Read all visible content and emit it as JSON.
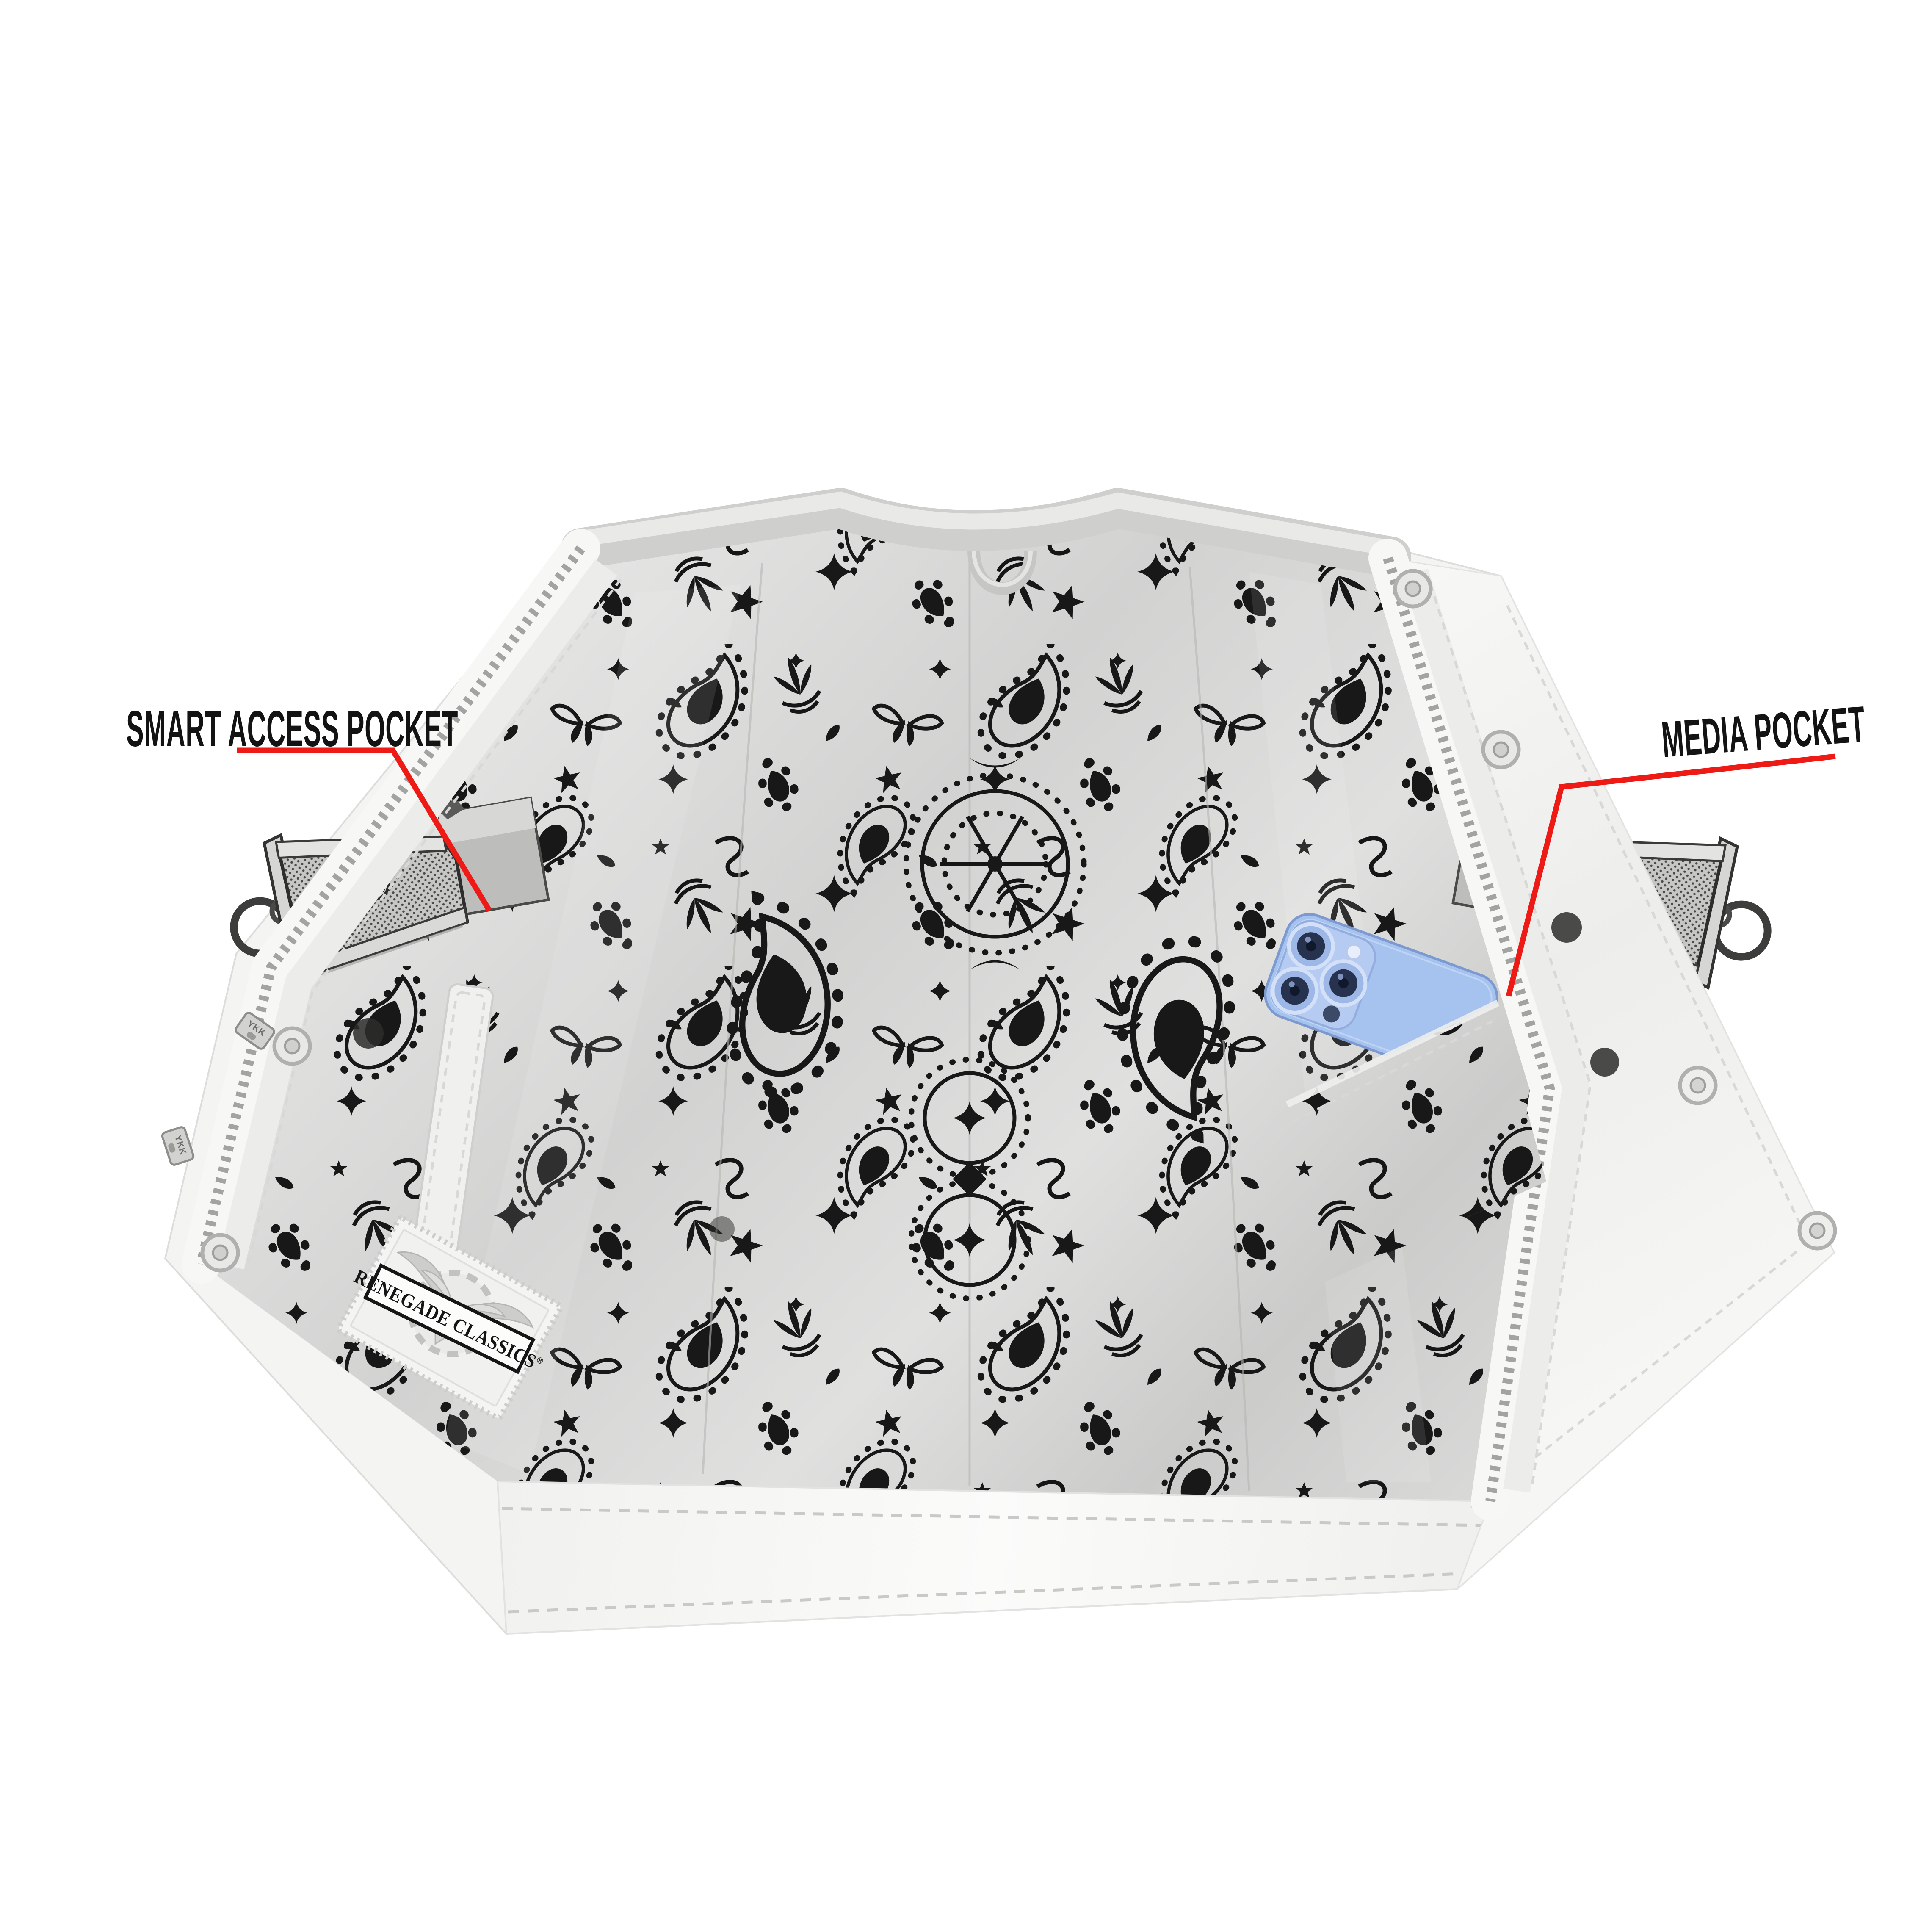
{
  "annotations": {
    "smart_access_pocket": "SMART ACCESS POCKET",
    "media_pocket": "MEDIA POCKET",
    "callout_color": "#ee1a16",
    "text_color": "#131313"
  },
  "brand_label": {
    "name": "RENEGADE CLASSICS",
    "reg": "®"
  },
  "hardware": {
    "zipper_pull_text": "YKK"
  },
  "colors": {
    "background": "#ffffff",
    "vest_white": "#f4f4f2",
    "lining_gray": "#d8d8d7",
    "paisley_black": "#181818",
    "collar_gray": "#d4d4d2",
    "phone_blue": "#a6c2ee",
    "gun_metal": "#c9c9c7"
  }
}
